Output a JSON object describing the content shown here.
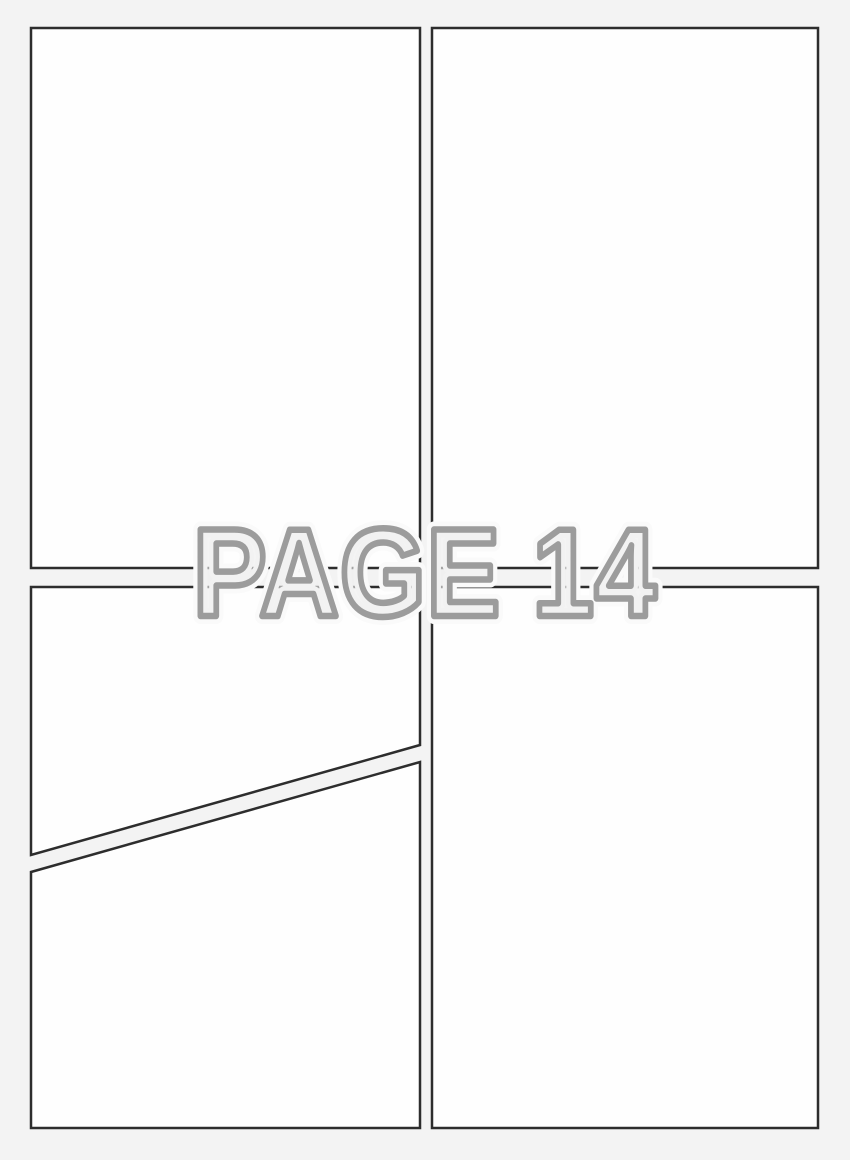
{
  "page": {
    "label": "PAGE 14"
  },
  "colors": {
    "background": "#f3f3f3",
    "panel_fill": "#fefefe",
    "panel_border": "#2d2d2d",
    "label_outline": "#9c9c9c",
    "label_fill": "#eeeeee",
    "label_halo": "#fafafa"
  },
  "panels": [
    {
      "id": "top-left"
    },
    {
      "id": "top-right"
    },
    {
      "id": "bottom-left-upper"
    },
    {
      "id": "bottom-left-lower"
    },
    {
      "id": "bottom-right"
    }
  ]
}
